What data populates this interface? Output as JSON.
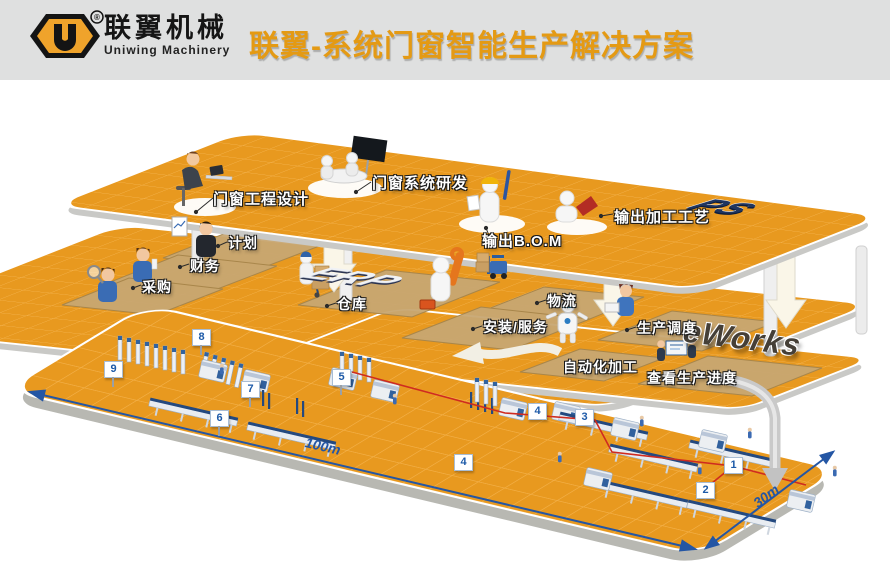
{
  "header": {
    "brand_cn": "联翼机械",
    "brand_en": "Uniwing Machinery",
    "reg": "®",
    "title": "联翼-系统门窗智能生产解决方案"
  },
  "colors": {
    "accent_orange": "#e49a14",
    "platform_orange": "#e8991f",
    "marker_blue": "#1d5aa8",
    "route_red": "#cf2b20",
    "mat_tan": "#c8a772"
  },
  "levels": {
    "design": {
      "system_label": "PS",
      "stations": [
        {
          "label": "门窗工程设计"
        },
        {
          "label": "门窗系统研发"
        },
        {
          "label": "输出B.O.M"
        },
        {
          "label": "输出加工工艺"
        }
      ]
    },
    "erp": {
      "system_label": "ERP",
      "stations": [
        {
          "label": "计划"
        },
        {
          "label": "财务"
        },
        {
          "label": "采购"
        },
        {
          "label": "仓库"
        },
        {
          "label": "物流"
        },
        {
          "label": "安装/服务"
        }
      ]
    },
    "eworks": {
      "system_label": "eWorks",
      "stations": [
        {
          "label": "生产调度"
        },
        {
          "label": "自动化加工"
        },
        {
          "label": "查看生产进度"
        }
      ]
    }
  },
  "floor": {
    "markers": [
      {
        "label": "1"
      },
      {
        "label": "2"
      },
      {
        "label": "3"
      },
      {
        "label": "4"
      },
      {
        "label": "4"
      },
      {
        "label": "5"
      },
      {
        "label": "6"
      },
      {
        "label": "7"
      },
      {
        "label": "8"
      },
      {
        "label": "9"
      }
    ],
    "dim_length": "100m",
    "dim_width": "30m"
  }
}
